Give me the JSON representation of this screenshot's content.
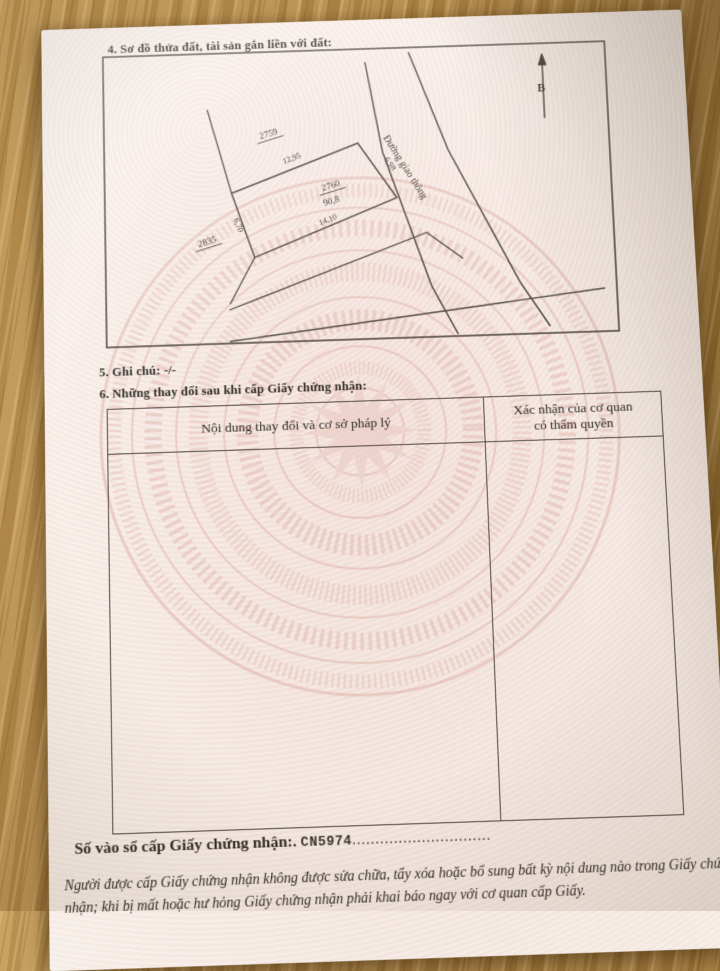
{
  "document": {
    "section4": {
      "title": "4. Sơ đồ thửa đất, tài sản gắn liền với đất:"
    },
    "diagram": {
      "north_label": "B",
      "road_label": "Đường giao thông",
      "plots": {
        "p2759": "2759",
        "p2760": "2760",
        "p2760_area": "90,8",
        "p2835": "2835"
      },
      "dimensions": {
        "top": "12,95",
        "right": "6,98",
        "left": "6,70",
        "bottom": "14,10"
      }
    },
    "section5": {
      "title": "5. Ghi chú: -/-"
    },
    "section6": {
      "title": "6. Những thay đổi sau khi cấp Giấy chứng nhận:",
      "table": {
        "col_content_header": "Nội dung thay đổi và cơ sở pháp lý",
        "col_confirm_header_line1": "Xác nhận của cơ quan",
        "col_confirm_header_line2": "có thẩm quyền"
      }
    },
    "footer": {
      "registry_label": "Số vào sổ cấp Giấy chứng nhận:.",
      "registry_number": "CN5974",
      "dotted_leader": "..............................",
      "notice": "Người được cấp Giấy chứng nhận không được sửa chữa, tẩy xóa hoặc bổ sung bất kỳ nội dung nào trong Giấy chứng nhận; khi bị mất hoặc hư hỏng Giấy chứng nhận phải khai báo ngay với cơ quan cấp Giấy."
    }
  }
}
